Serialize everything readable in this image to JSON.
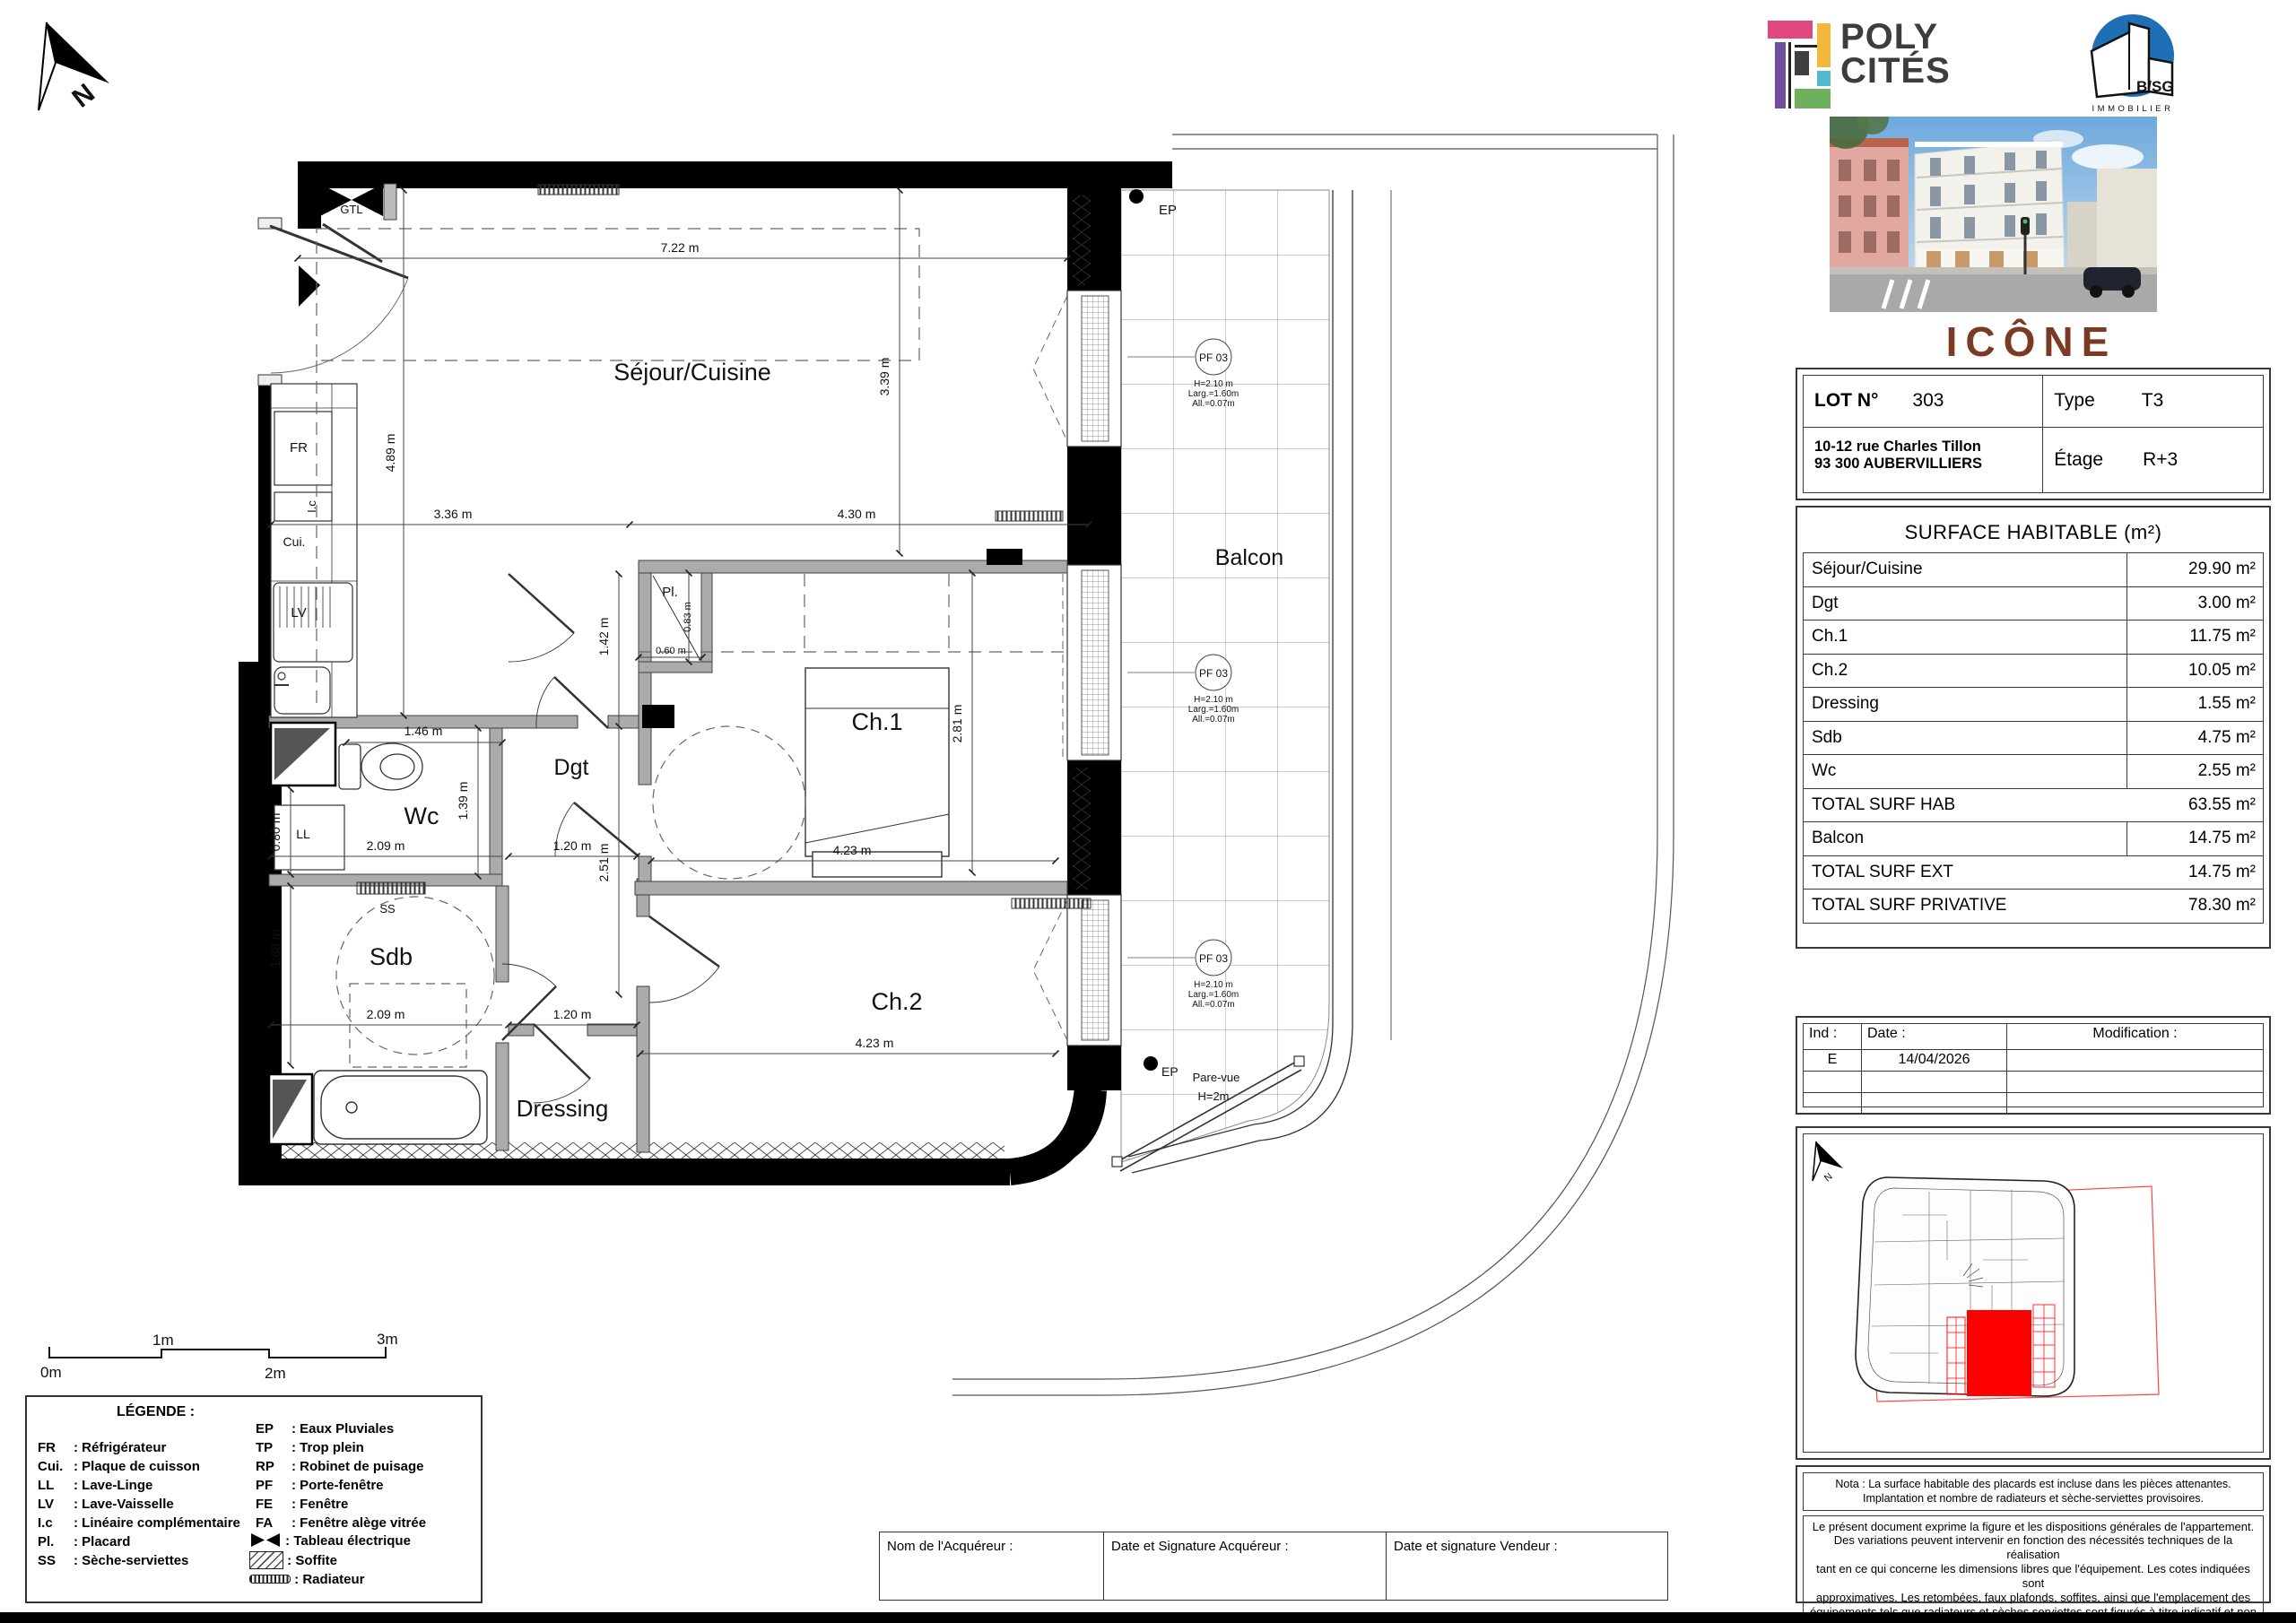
{
  "colors": {
    "wall": "#000000",
    "interior_wall": "#ababab",
    "pf_red": "#ff3b30",
    "site_red": "#ff0000",
    "project_brown": "#7b3a23",
    "bsg_blue": "#1e6fb5",
    "poly_pink": "#e0487e",
    "poly_purple": "#6d4f9e",
    "poly_yellow": "#f3b73a",
    "poly_teal": "#52b9cf",
    "poly_green": "#6fb05c"
  },
  "plan": {
    "north": "N",
    "rooms": {
      "sejour": "Séjour/Cuisine",
      "balcon": "Balcon",
      "ch1": "Ch.1",
      "ch2": "Ch.2",
      "dgt": "Dgt",
      "wc": "Wc",
      "sdb": "Sdb",
      "dressing": "Dressing"
    },
    "fixtures": {
      "gtl": "GTL",
      "fr": "FR",
      "ic": "I.c",
      "cui": "Cui.",
      "lv": "LV",
      "ll": "LL",
      "ss": "SS",
      "pl": "Pl.",
      "ep": "EP",
      "pare_vue_1": "Pare-vue",
      "pare_vue_2": "H=2m"
    },
    "dims": {
      "sejour_w": "7.22 m",
      "kitchen_h": "4.89 m",
      "kitchen_w": "3.36 m",
      "sejour_right_w": "4.30 m",
      "sejour_h": "3.39 m",
      "dgt_h1": "1.42 m",
      "dgt_h2": "2.51 m",
      "dgt_w": "1.20 m",
      "wc_door": "1.46 m",
      "wc_h": "1.39 m",
      "wc_w": "2.09 m",
      "ll_h": "0.80 m",
      "sdb_h": "1.68 m",
      "sdb_w": "2.09 m",
      "dressing_w": "1.20 m",
      "ch1_w": "4.23 m",
      "ch1_h": "2.81 m",
      "ch2_w": "4.23 m",
      "pl_h": "0.83 m",
      "pl_w": "0.60 m"
    },
    "pf": {
      "tag": "PF 03",
      "h": "H=2.10 m",
      "larg": "Larg.=1.60m",
      "all": "All.=0.07m"
    },
    "scale": {
      "m0": "0m",
      "m1": "1m",
      "m2": "2m",
      "m3": "3m"
    }
  },
  "legend": {
    "title": "LÉGENDE :",
    "left": [
      {
        "abbr": "FR",
        "desc": ": Réfrigérateur"
      },
      {
        "abbr": "Cui.",
        "desc": ": Plaque de cuisson"
      },
      {
        "abbr": "LL",
        "desc": ": Lave-Linge"
      },
      {
        "abbr": "LV",
        "desc": ": Lave-Vaisselle"
      },
      {
        "abbr": "I.c",
        "desc": ": Linéaire complémentaire"
      },
      {
        "abbr": "Pl.",
        "desc": ": Placard"
      },
      {
        "abbr": "SS",
        "desc": ": Sèche-serviettes"
      }
    ],
    "right": [
      {
        "abbr": "EP",
        "desc": ": Eaux Pluviales"
      },
      {
        "abbr": "TP",
        "desc": ": Trop plein"
      },
      {
        "abbr": "RP",
        "desc": ": Robinet de puisage"
      },
      {
        "abbr": "PF",
        "desc": ": Porte-fenêtre"
      },
      {
        "abbr": "FE",
        "desc": ": Fenêtre"
      },
      {
        "abbr": "FA",
        "desc": ": Fenêtre alège vitrée"
      }
    ],
    "symbols": [
      {
        "desc": ": Tableau électrique",
        "icon": "electrical-panel-icon"
      },
      {
        "desc": ": Soffite",
        "icon": "soffit-hatch-icon"
      },
      {
        "desc": ": Radiateur",
        "icon": "radiator-icon"
      }
    ]
  },
  "brand": {
    "poly1": "POLY",
    "poly2": "CITÉS",
    "bsg": "B/SG",
    "bsg_sub": "IMMOBILIER",
    "project": "ICÔNE"
  },
  "lot": {
    "lot_label": "LOT N°",
    "lot_value": "303",
    "type_label": "Type",
    "type_value": "T3",
    "address1": "10-12 rue Charles Tillon",
    "address2": "93 300 AUBERVILLIERS",
    "floor_label": "Étage",
    "floor_value": "R+3"
  },
  "surface": {
    "title": "SURFACE HABITABLE (m²)",
    "rows": [
      {
        "label": "Séjour/Cuisine",
        "value": "29.90 m²"
      },
      {
        "label": "Dgt",
        "value": "3.00 m²"
      },
      {
        "label": "Ch.1",
        "value": "11.75 m²"
      },
      {
        "label": "Ch.2",
        "value": "10.05 m²"
      },
      {
        "label": "Dressing",
        "value": "1.55 m²"
      },
      {
        "label": "Sdb",
        "value": "4.75 m²"
      },
      {
        "label": "Wc",
        "value": "2.55 m²"
      },
      {
        "label": "TOTAL SURF HAB",
        "value": "63.55 m²"
      },
      {
        "label": "Balcon",
        "value": "14.75 m²"
      },
      {
        "label": "TOTAL SURF EXT",
        "value": "14.75 m²"
      },
      {
        "label": "TOTAL SURF PRIVATIVE",
        "value": "78.30 m²"
      }
    ]
  },
  "revisions": {
    "h_ind": "Ind :",
    "h_date": "Date :",
    "h_mod": "Modification :",
    "rows": [
      {
        "ind": "E",
        "date": "14/04/2026",
        "mod": ""
      },
      {
        "ind": "",
        "date": "",
        "mod": ""
      },
      {
        "ind": "",
        "date": "",
        "mod": ""
      }
    ]
  },
  "nota1": "Nota : La surface habitable des placards est incluse dans les pièces attenantes.\nImplantation et nombre de radiateurs et sèche-serviettes provisoires.",
  "nota2": "Le présent document exprime la figure et les dispositions générales de l'appartement.\nDes variations peuvent intervenir en fonction des nécessités techniques de la réalisation\ntant en ce qui concerne les dimensions libres que l'équipement. Les cotes indiquées sont\napproximatives. Les retombées, faux plafonds, soffites, ainsi que l'emplacement des\néquipements tels que radiateurs et sèches serviettes sont figurés à titre indicatif et non\nlimitatif. Les surfaces habitables sont conformes au décret du 23 Mars 1997 (Art. 4.1)",
  "signature": {
    "c1": "Nom de l'Acquéreur :",
    "c2": "Date et Signature Acquéreur  :",
    "c3": "Date et signature Vendeur :"
  }
}
